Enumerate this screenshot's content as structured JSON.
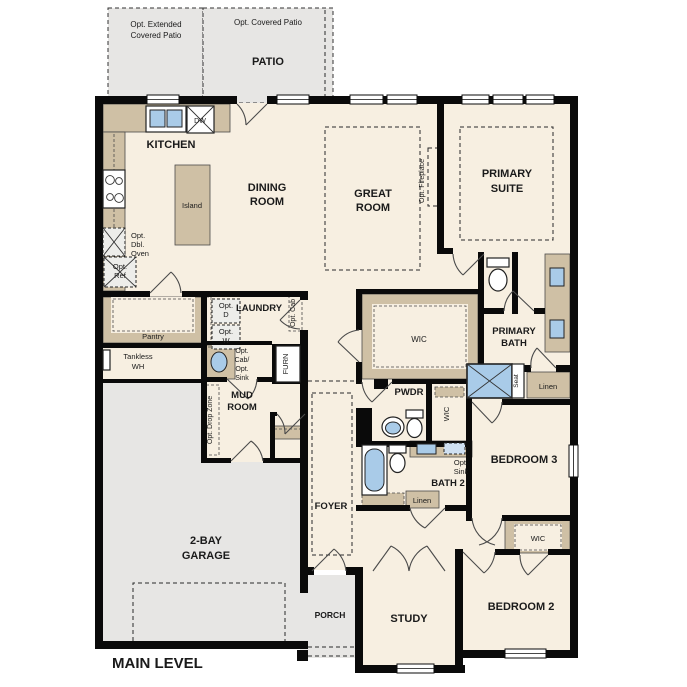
{
  "plan": {
    "title": "MAIN LEVEL",
    "colors": {
      "floor": "#f7efe1",
      "outdoor_concrete": "#e7e6e4",
      "cabinet_tan": "#cfc0a5",
      "fixture_blue": "#a9cbe8",
      "wall": "#0a0a0a"
    },
    "outdoor": {
      "extended_patio": [
        "Opt. Extended",
        "Covered Patio"
      ],
      "covered_patio": "Opt. Covered Patio",
      "patio": "PATIO",
      "porch": "PORCH"
    },
    "rooms": {
      "kitchen": "KITCHEN",
      "dining": [
        "DINING",
        "ROOM"
      ],
      "great": [
        "GREAT",
        "ROOM"
      ],
      "primary_suite": [
        "PRIMARY",
        "SUITE"
      ],
      "pantry": "Pantry",
      "laundry": "LAUNDRY",
      "mud": [
        "MUD",
        "ROOM"
      ],
      "wic_primary": "WIC",
      "primary_bath": [
        "PRIMARY",
        "BATH"
      ],
      "pwdr": "PWDR",
      "wic_bedroom3": "WIC",
      "bedroom3": "BEDROOM 3",
      "bath2": "BATH 2",
      "linen_primary": "Linen",
      "linen_hall": "Linen",
      "foyer": "FOYER",
      "garage": [
        "2-BAY",
        "GARAGE"
      ],
      "study": "STUDY",
      "bedroom2": "BEDROOM 2",
      "wic_bedroom2": "WIC"
    },
    "fixtures": {
      "island": "Island",
      "dw": "DW",
      "opt_dbl_oven": [
        "Opt.",
        "Dbl.",
        "Oven"
      ],
      "opt_ref": [
        "Opt.",
        "Ref"
      ],
      "tankless": [
        "Tankless",
        "WH"
      ],
      "opt_dryer": [
        "Opt.",
        "D"
      ],
      "opt_washer": [
        "Opt.",
        "W"
      ],
      "opt_cab": "Opt. Cab",
      "opt_cab_sink": [
        "Opt.",
        "Cab/",
        "Opt.",
        "Sink"
      ],
      "furnace": "FURN",
      "opt_drop_zone": "Opt. Drop Zone",
      "opt_fireplace": "Opt. Fireplace",
      "seat": "Seat",
      "opt_sink": [
        "Opt.",
        "Sink"
      ]
    }
  }
}
